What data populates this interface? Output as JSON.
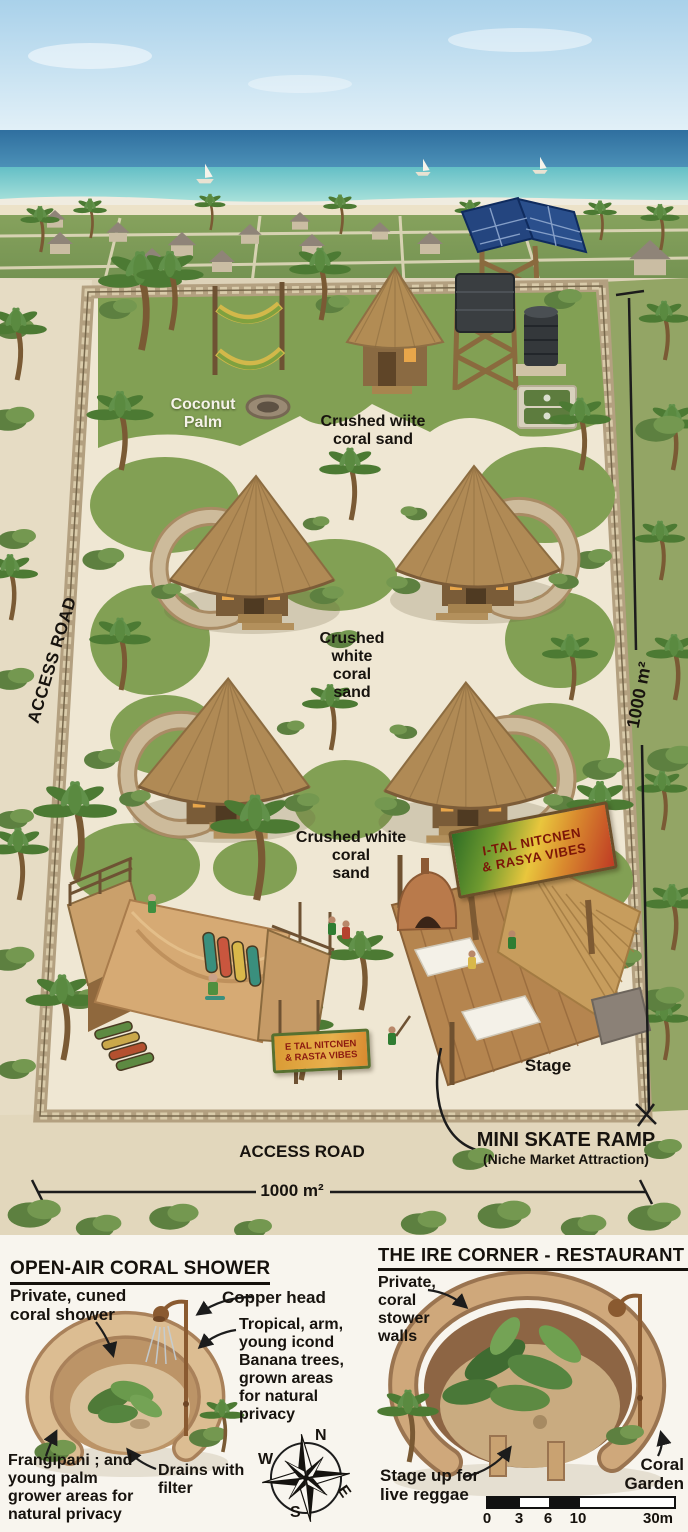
{
  "title": "Eco-resort site plan illustration",
  "colors": {
    "rasta_green": "#2e6d25",
    "rasta_yellow": "#e9c63d",
    "rasta_red": "#bf3a24",
    "sea_deep": "#2f6f9f",
    "lagoon_turquoise": "#6cc3c9",
    "sand_path": "#efe7d3",
    "thatch_roof": "#b08a55",
    "stone_wall": "#c9b795",
    "grass": "#82a054"
  },
  "plan": {
    "label_coconut_palm": "Coconut\nPalm",
    "label_sand_top": "Crushed wiite\ncoral sand",
    "label_sand_mid": "Crushed\nwhite\ncoral\nsand",
    "label_sand_lower": "Crushed white\ncoral\nsand",
    "access_road_left": "ACCESS ROAD",
    "access_road_bottom": "ACCESS ROAD",
    "dim_right": "1000 m²",
    "dim_bottom": "1000 m²",
    "stage": "Stage",
    "skate_title": "MINI SKATE RAMP",
    "skate_sub": "(Niche Market Attraction)",
    "sign_main": "I-TAL NITCNEN\n& RASYA VIBES",
    "sign_small": "E TAL NITCNEN\n& RASTA VIBES"
  },
  "shower_panel": {
    "title": "OPEN-AIR CORAL SHOWER",
    "label_private": "Private, cuned\ncoral shower",
    "label_copper": "Copper head",
    "label_tropical": "Tropical, arm,\nyoung icond\nBanana trees,\ngrown areas\nfor natural\nprivacy",
    "label_frangipani": "Frangipani ; and\nyoung palm\ngrower areas for\nnatural privacy",
    "label_drains": "Drains with\nfilter"
  },
  "bar_panel": {
    "title": "THE IRE CORNER - RESTAURANT & BAR",
    "label_walls": "Private,\ncoral\nstower\nwalls",
    "label_stage_up": "Stage up for\nlive reggae",
    "label_coral_garden": "Coral\nGarden"
  },
  "compass": {
    "n": "N",
    "w": "W",
    "s": "S",
    "e": "E"
  },
  "scale_bar": {
    "ticks": [
      "0",
      "3",
      "6",
      "10",
      "30m"
    ]
  }
}
